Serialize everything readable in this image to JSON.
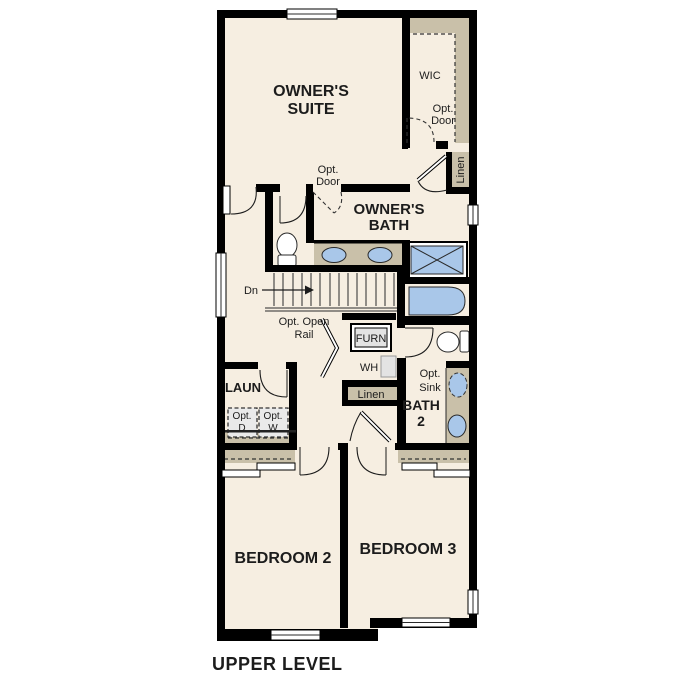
{
  "palette": {
    "background": "#ffffff",
    "floor": "#f6eee1",
    "wall": "#000000",
    "cabinet_tan": "#c9c0a9",
    "fixture_blue": "#a9c7e9",
    "appliance_gray": "#e3e3e3",
    "text": "#1c1c1c"
  },
  "plan": {
    "caption": "UPPER LEVEL",
    "rooms": {
      "owners_suite": {
        "line1": "OWNER'S",
        "line2": "SUITE"
      },
      "owners_bath": {
        "line1": "OWNER'S",
        "line2": "BATH"
      },
      "wic": {
        "label": "WIC"
      },
      "laundry": {
        "label": "LAUN"
      },
      "bath2": {
        "line1": "BATH",
        "line2": "2"
      },
      "bedroom2": {
        "label": "BEDROOM 2"
      },
      "bedroom3": {
        "label": "BEDROOM 3"
      }
    },
    "closets": {
      "linen_upper": {
        "label": "Linen"
      },
      "linen_hall": {
        "label": "Linen"
      }
    },
    "annotations": {
      "opt_door_wic": {
        "line1": "Opt.",
        "line2": "Door"
      },
      "opt_door_suite": {
        "line1": "Opt.",
        "line2": "Door"
      },
      "stairs_dn": {
        "label": "Dn"
      },
      "opt_open_rail": {
        "line1": "Opt. Open",
        "line2": "Rail"
      },
      "furnace": {
        "label": "FURN"
      },
      "water_heater": {
        "label": "WH"
      },
      "opt_dryer": {
        "line1": "Opt.",
        "line2": "D"
      },
      "opt_washer": {
        "line1": "Opt.",
        "line2": "W"
      },
      "opt_sink": {
        "line1": "Opt.",
        "line2": "Sink"
      }
    }
  }
}
